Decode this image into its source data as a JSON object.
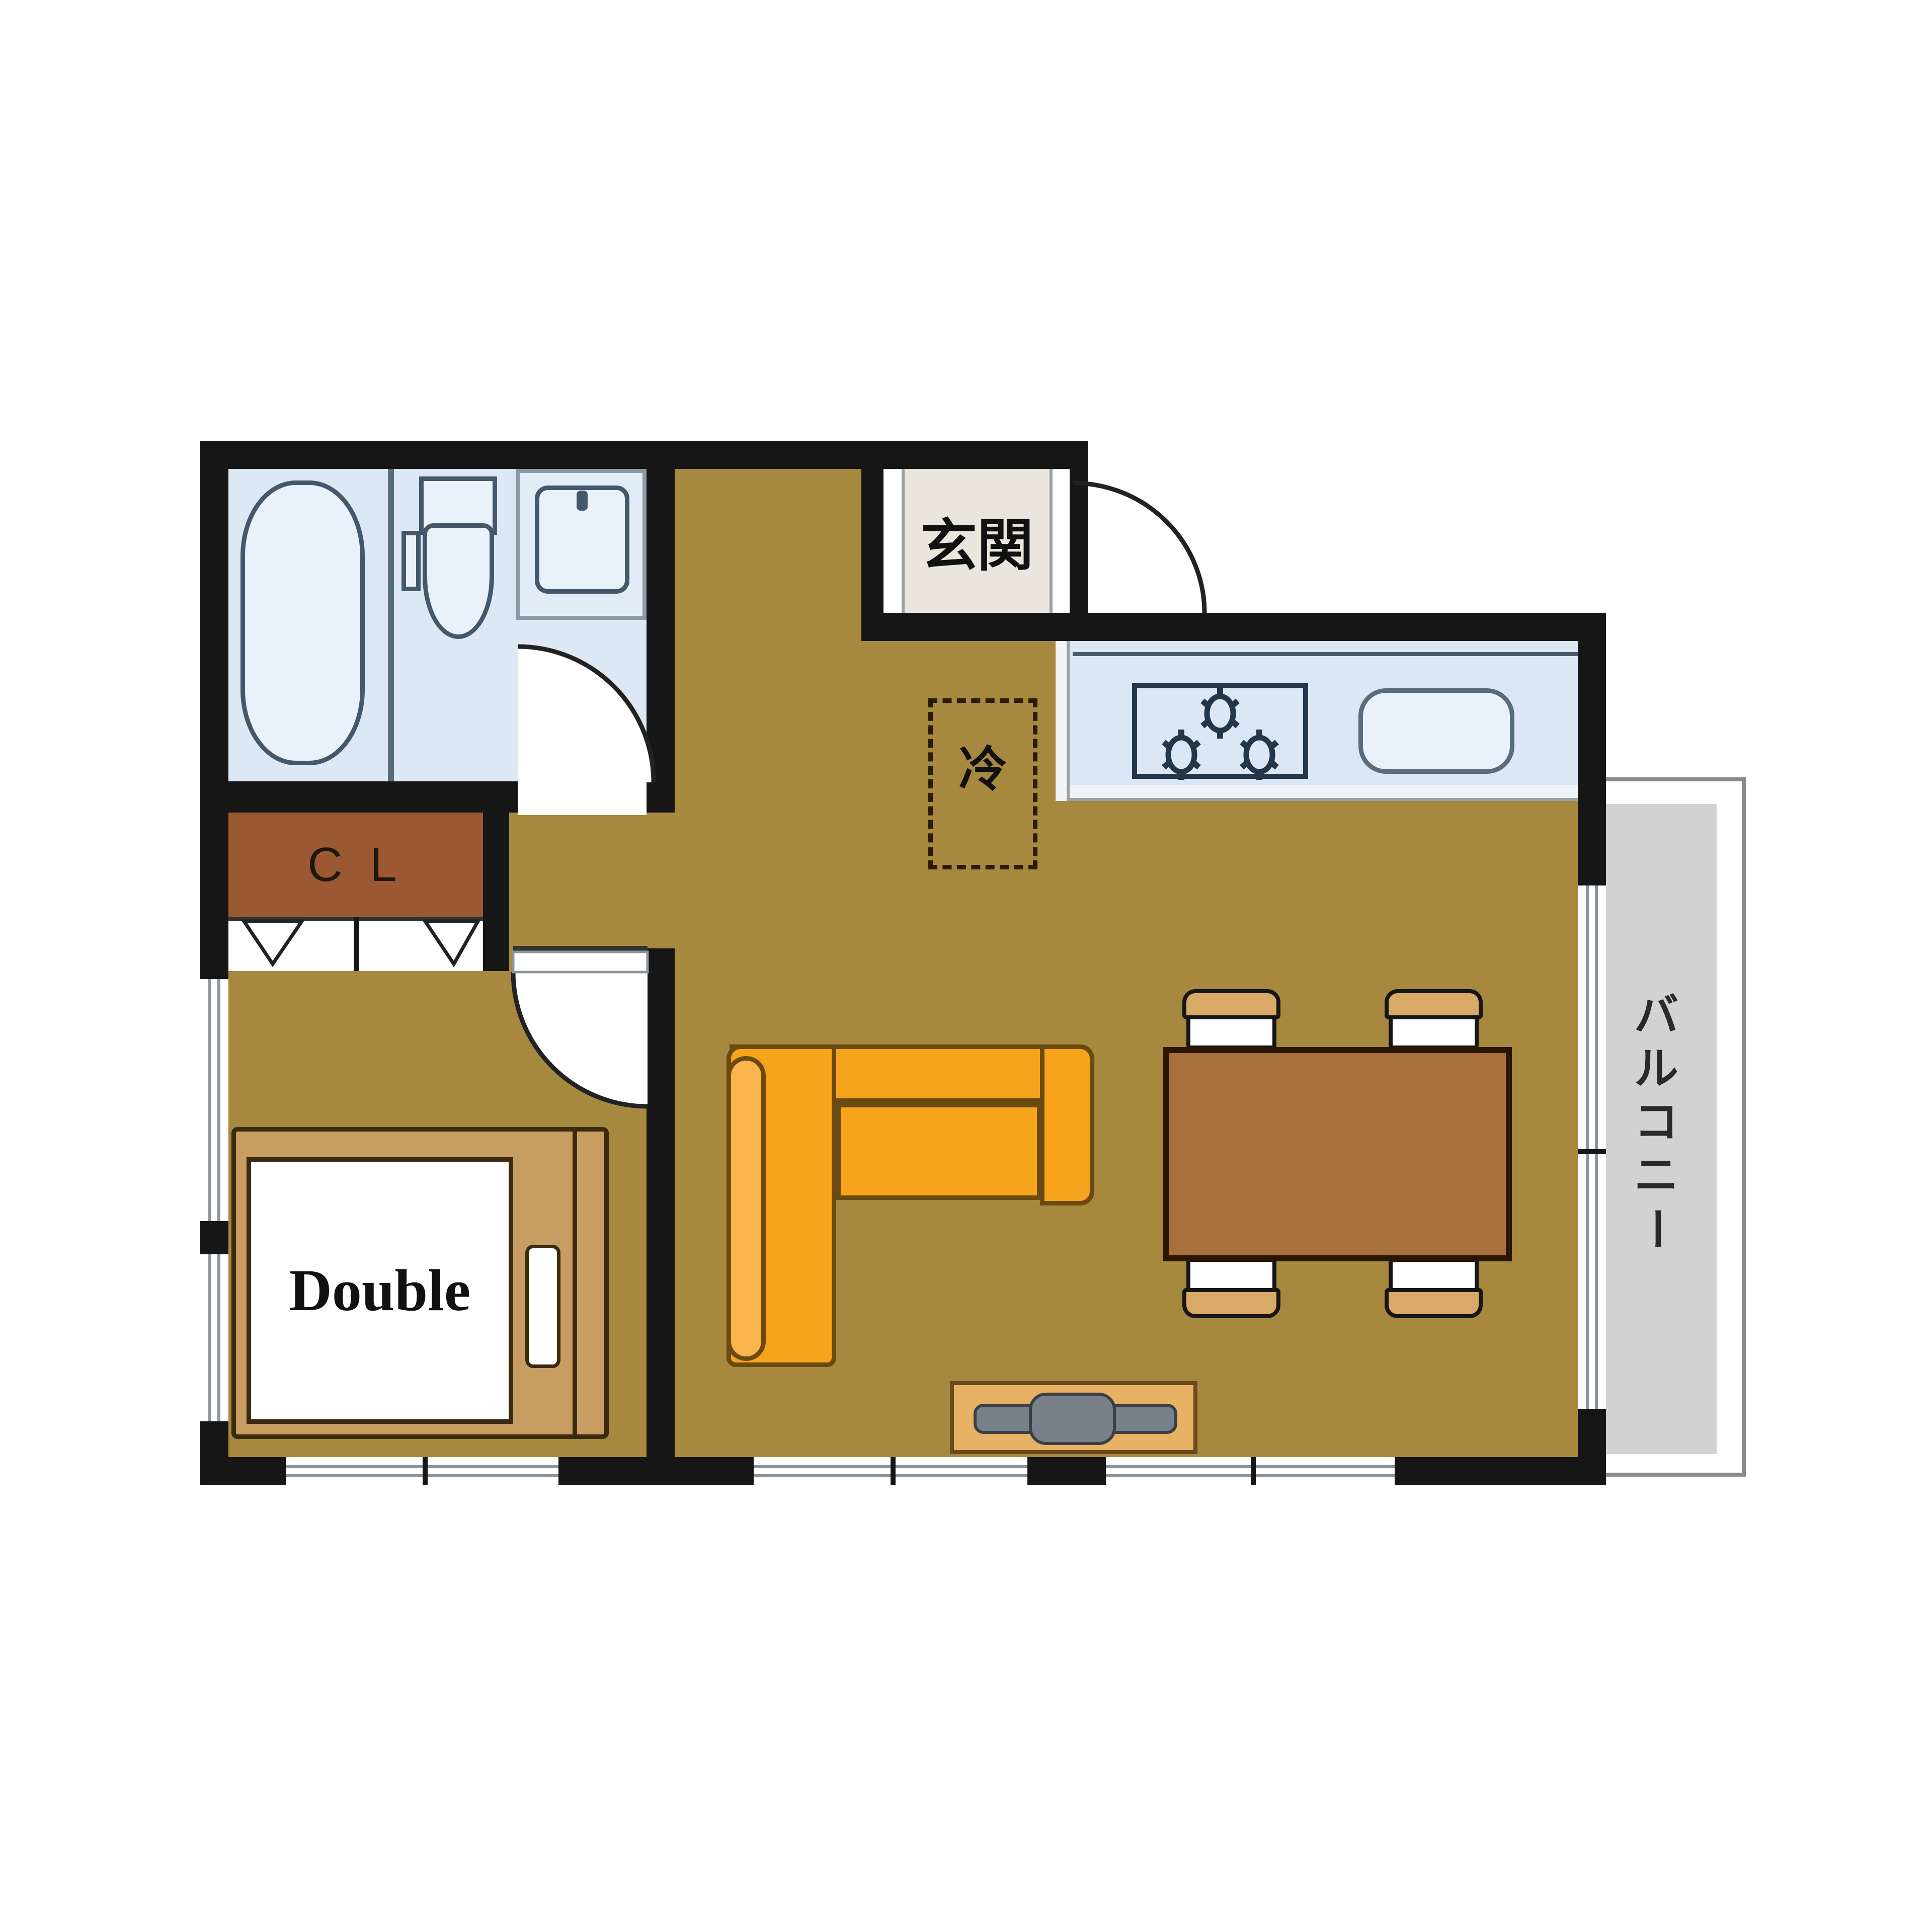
{
  "labels": {
    "entrance": "玄関",
    "refrigerator": "冷",
    "closet": "C L",
    "bed": "Double",
    "balcony": "バルコニー"
  },
  "icons": {
    "bathtub-icon": "rounded-rectangle tub outline",
    "toilet-icon": "tank and bowl outline",
    "sink-icon": "rounded basin with faucet dot",
    "stove-icon": "three burner asterisks in box",
    "kitchen-sink-icon": "rounded rectangle",
    "door-arc-icon": "quarter-circle swing arc",
    "bifold-door-icon": "double V marks",
    "window-icon": "double parallel lines in wall",
    "sofa-icon": "L-shaped sofa",
    "dining-set-icon": "table with four chairs",
    "tv-board-icon": "board with TV bar"
  },
  "colors": {
    "floor": "#a6883f",
    "wall": "#161616",
    "bath_fill": "#dce8f4",
    "fixture_fill": "#e9f1fa",
    "fixture_line": "#44576b",
    "closet_fill": "#9a5932",
    "entrance_fill": "#eae6dd",
    "balcony_fill": "#d2d2d2",
    "balcony_line": "#8a8a8a",
    "sofa": "#f7a41d",
    "sofa_light": "#f9b54b",
    "table": "#a8703c",
    "chair_back": "#d9a968",
    "bed_frame": "#c79d62",
    "tv_board": "#e8b264",
    "tv": "#78808a"
  }
}
